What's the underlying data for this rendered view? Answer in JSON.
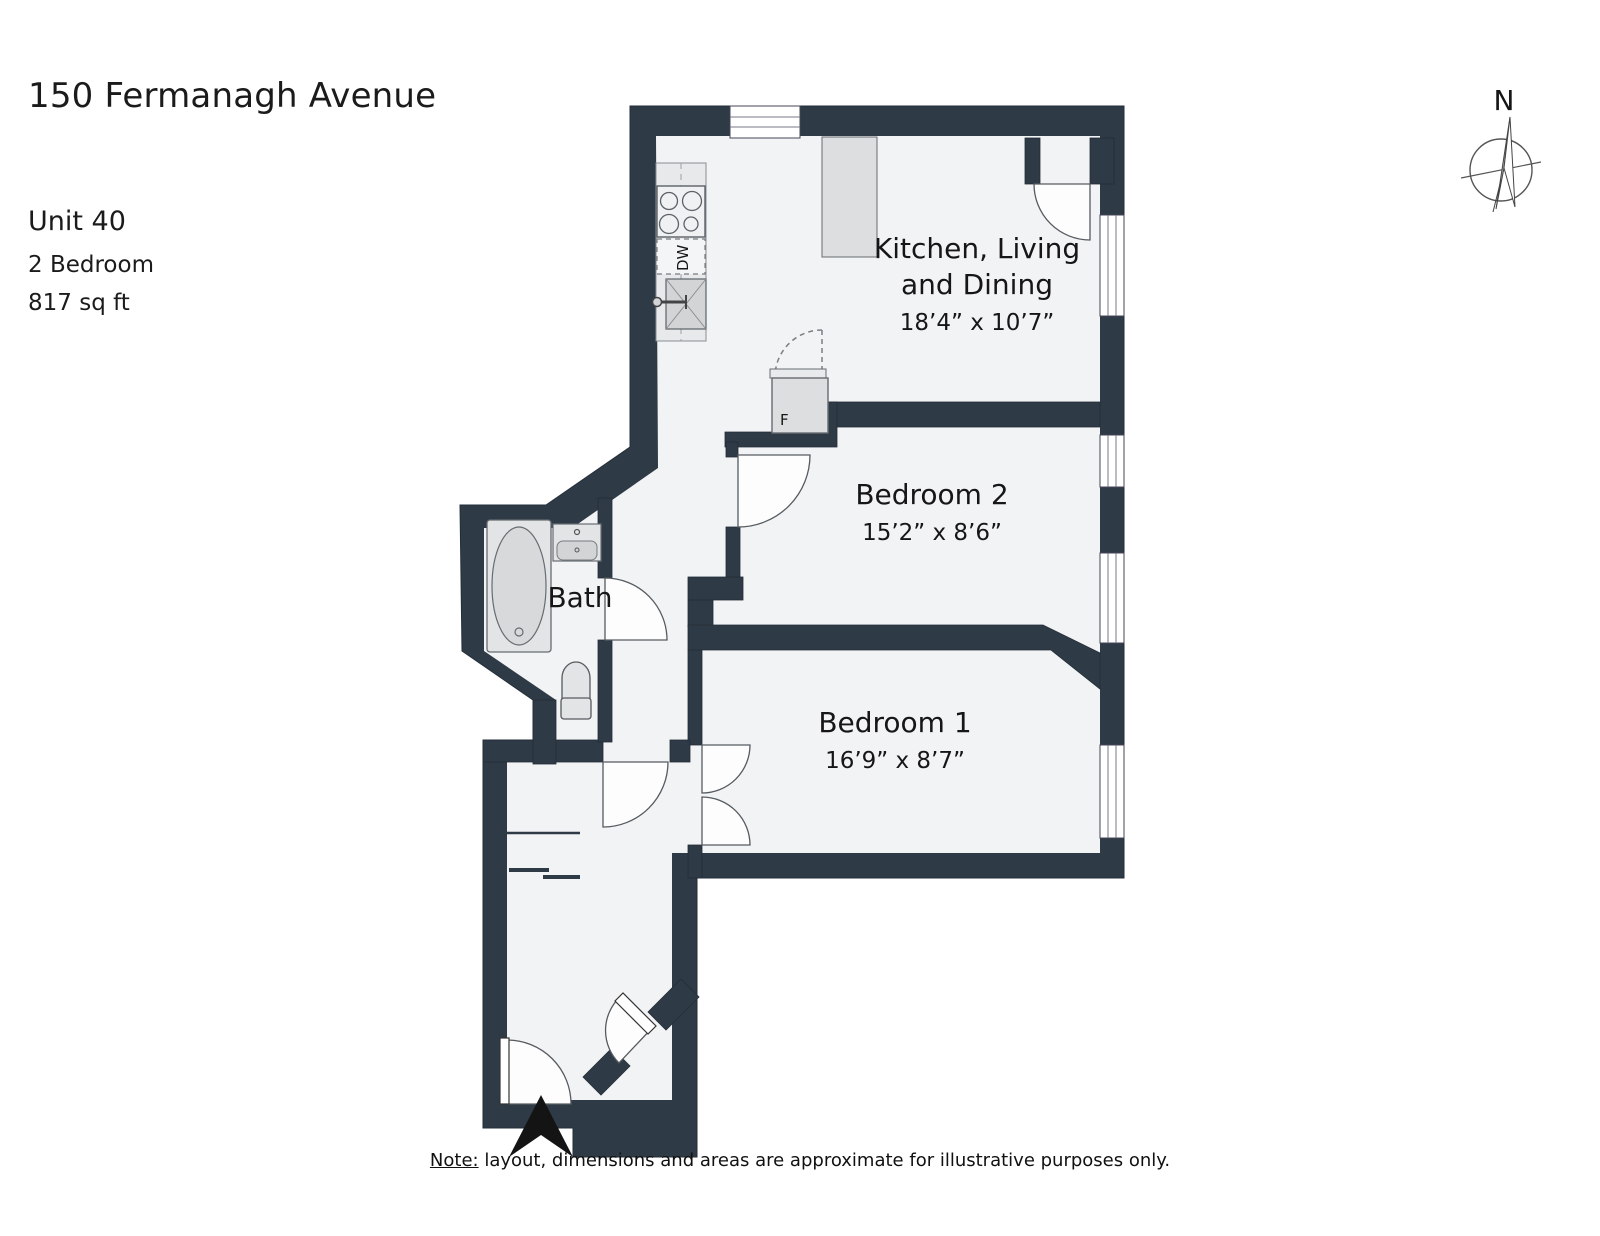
{
  "header": {
    "address": "150 Fermanagh Avenue",
    "unit": "Unit 40",
    "bedrooms": "2 Bedroom",
    "area": "817 sq ft"
  },
  "rooms": {
    "kitchen_living_dining": {
      "label_line1": "Kitchen, Living",
      "label_line2": "and Dining",
      "dimensions": "18’4” x 10’7”"
    },
    "bedroom2": {
      "label": "Bedroom 2",
      "dimensions": "15’2” x 8’6”"
    },
    "bedroom1": {
      "label": "Bedroom 1",
      "dimensions": "16’9” x 8’7”"
    },
    "bath": {
      "label": "Bath"
    }
  },
  "fixtures": {
    "dishwasher_label": "DW",
    "fridge_label": "F"
  },
  "compass": {
    "north_label": "N"
  },
  "note": {
    "prefix": "Note:",
    "body": " layout, dimensions and areas are approximate for illustrative purposes only."
  },
  "colors": {
    "wall": "#2e3a45",
    "floor": "#f2f3f5",
    "counter": "#e8e9ea",
    "island": "#dcdee0",
    "fixture_light": "#e3e4e6",
    "fixture_mid": "#d2d4d6"
  }
}
